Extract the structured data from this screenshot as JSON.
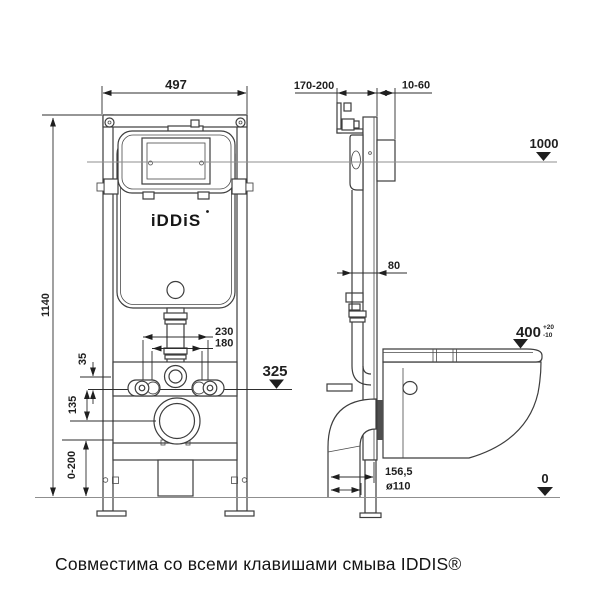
{
  "page": {
    "caption": "Совместима со всеми клавишами смыва IDDIS®"
  },
  "logo": {
    "text": "iDDiS"
  },
  "dims": {
    "front_width": "497",
    "front_height": "1140",
    "bolt_outer": "230",
    "bolt_inner": "180",
    "offset_35": "35",
    "offset_135": "135",
    "leg_range": "0-200",
    "level_325": "325",
    "depth_range": "170-200",
    "wall_range": "10-60",
    "inlet_80": "80",
    "level_1000": "1000",
    "level_400": "400",
    "tol_plus": "+20",
    "tol_minus": "-10",
    "drain_156": "156,5",
    "drain_dia": "ø110",
    "level_0": "0"
  }
}
